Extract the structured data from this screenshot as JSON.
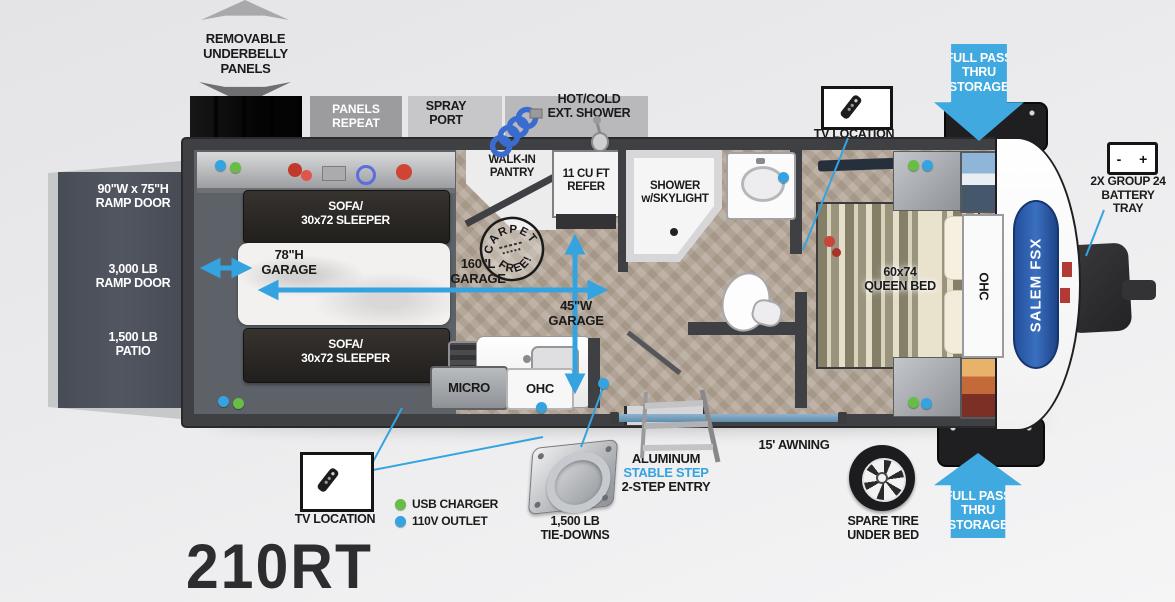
{
  "model_number": "210RT",
  "colors": {
    "accent_blue": "#3fa9e0",
    "usb_green": "#67bd45",
    "outlet_blue": "#35a3e0",
    "wall_dark": "#3f4043",
    "label_black": "#1a1a1a"
  },
  "annotations": {
    "removable_underbelly": "REMOVABLE\nUNDERBELLY\nPANELS",
    "panels_repeat": "PANELS\nREPEAT",
    "spray_port": "SPRAY\nPORT",
    "ext_shower": "HOT/COLD\nEXT. SHOWER",
    "full_pass_thru_top": "FULL PASS\nTHRU\nSTORAGE",
    "tv_location_top": "TV LOCATION",
    "battery_tray": "2X GROUP 24\nBATTERY\nTRAY",
    "battery_icon_text": "-  +",
    "tv_location_bottom": "TV LOCATION",
    "usb_charger": "USB CHARGER",
    "outlet_110v": "110V OUTLET",
    "tie_downs": "1,500 LB\nTIE-DOWNS",
    "step_line1": "ALUMINUM",
    "step_line2": "STABLE STEP",
    "step_line3": "2-STEP ENTRY",
    "awning": "15' AWNING",
    "spare_tire": "SPARE TIRE\nUNDER BED",
    "full_pass_thru_bottom": "FULL PASS\nTHRU\nSTORAGE"
  },
  "rooms": {
    "ramp_door_size": "90\"W x 75\"H\nRAMP DOOR",
    "ramp_door_capacity": "3,000 LB\nRAMP DOOR",
    "patio_capacity": "1,500 LB\nPATIO",
    "sofa_top": "SOFA/\n30x72 SLEEPER",
    "sofa_bottom": "SOFA/\n30x72 SLEEPER",
    "garage_height": "78\"H\nGARAGE",
    "garage_length": "160\"L\nGARAGE",
    "garage_width": "45\"W\nGARAGE",
    "stamp_top": "CARPET",
    "stamp_bottom": "FREE!",
    "walk_in_pantry": "WALK-IN\nPANTRY",
    "refrigerator": "11 CU FT\nREFER",
    "shower": "SHOWER\nw/SKYLIGHT",
    "microwave": "MICRO",
    "overhead_cabinet_kitchen": "OHC",
    "overhead_cabinet_bedroom": "OHC",
    "queen_bed": "60x74\nQUEEN BED",
    "brand_logo": "SALEM FSX"
  }
}
